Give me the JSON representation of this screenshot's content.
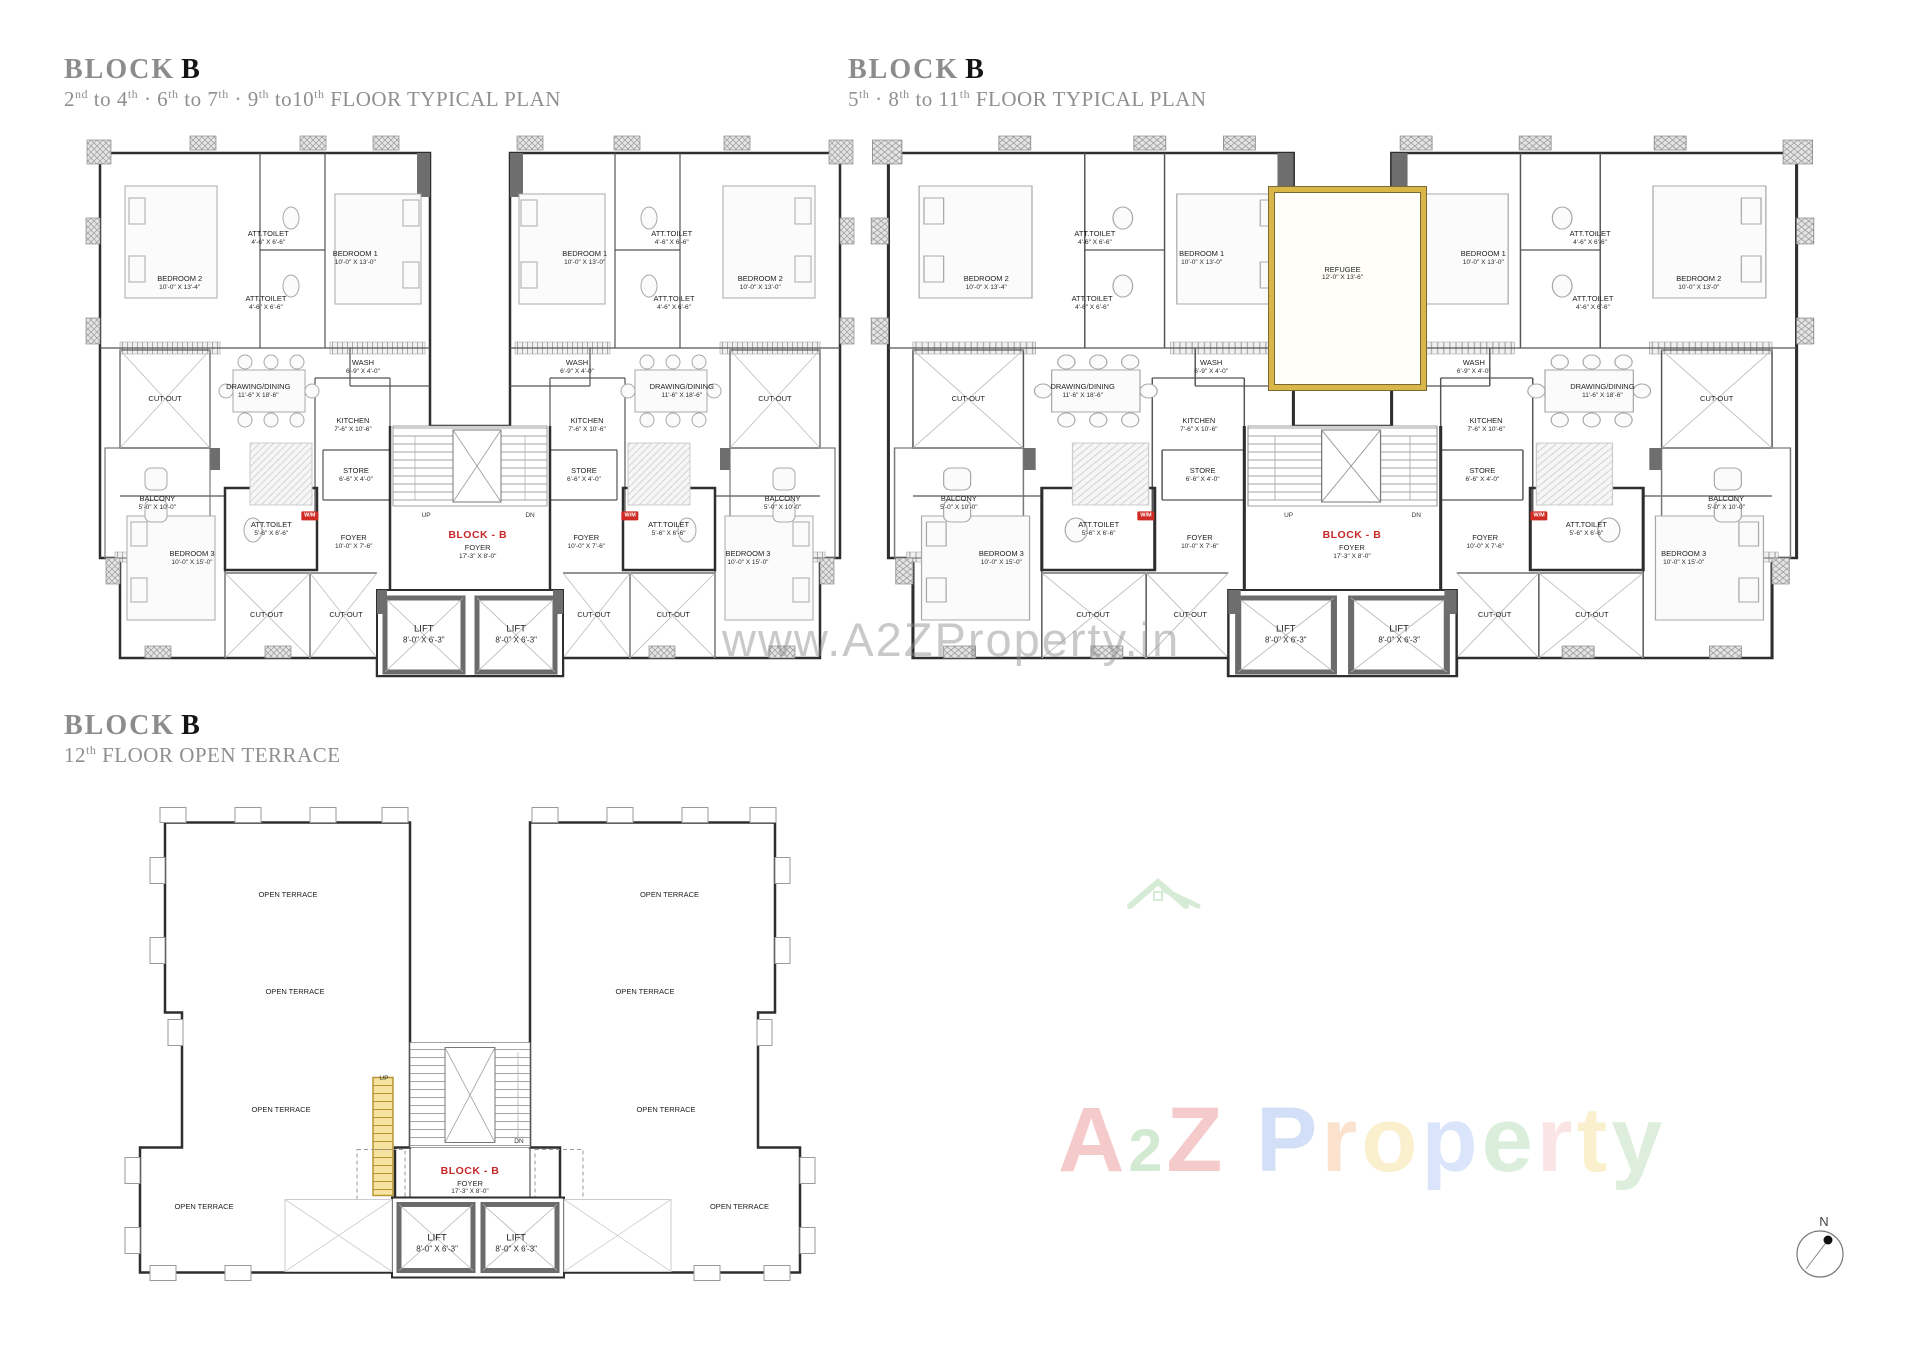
{
  "titles": [
    {
      "block": "BLOCK",
      "b": "B",
      "subtitle_parts": [
        [
          "2",
          "nd"
        ],
        [
          " to 4",
          "th"
        ],
        [
          " · 6",
          "th"
        ],
        [
          " to 7",
          "th"
        ],
        [
          " · 9",
          "th"
        ],
        [
          " to10",
          "th"
        ],
        [
          " FLOOR TYPICAL PLAN",
          ""
        ]
      ]
    },
    {
      "block": "BLOCK",
      "b": "B",
      "subtitle_parts": [
        [
          "5",
          "th"
        ],
        [
          " · 8",
          "th"
        ],
        [
          " to 11",
          "th"
        ],
        [
          " FLOOR TYPICAL PLAN",
          ""
        ]
      ]
    },
    {
      "block": "BLOCK",
      "b": "B",
      "subtitle_parts": [
        [
          "12",
          "th"
        ],
        [
          " FLOOR OPEN TERRACE",
          ""
        ]
      ]
    }
  ],
  "typical_rooms": [
    {
      "id": "bedroom2-left",
      "x": 12.3,
      "y": 27.7,
      "lines": [
        "BEDROOM 2",
        "10'-0\" X 13'-4\""
      ]
    },
    {
      "id": "att-toilet-upper-left",
      "x": 23.8,
      "y": 19.6,
      "lines": [
        "ATT.TOILET",
        "4'-6\" X 6'-6\""
      ]
    },
    {
      "id": "att-toilet-lower-left",
      "x": 23.5,
      "y": 31.3,
      "lines": [
        "ATT.TOILET",
        "4'-6\" X 6'-6\""
      ]
    },
    {
      "id": "bedroom1-left",
      "x": 35.1,
      "y": 23.2,
      "lines": [
        "BEDROOM 1",
        "10'-0\" X 13'-0\""
      ]
    },
    {
      "id": "wash-left",
      "x": 36.1,
      "y": 42.7,
      "lines": [
        "WASH",
        "6'-9\" X 4'-0\""
      ]
    },
    {
      "id": "cutout-upper-left",
      "x": 10.4,
      "y": 48.4,
      "lines": [
        "CUT-OUT"
      ]
    },
    {
      "id": "drawing-dining-left",
      "x": 22.5,
      "y": 47.0,
      "lines": [
        "DRAWING/DINING",
        "11'-6\" X 18'-6\""
      ]
    },
    {
      "id": "kitchen-left",
      "x": 34.8,
      "y": 53.0,
      "lines": [
        "KITCHEN",
        "7'-6\" X 10'-6\""
      ]
    },
    {
      "id": "balcony-left",
      "x": 9.4,
      "y": 67.0,
      "lines": [
        "BALCONY",
        "5'-0\" X 10'-0\""
      ]
    },
    {
      "id": "store-left",
      "x": 35.2,
      "y": 62.0,
      "lines": [
        "STORE",
        "6'-6\" X 4'-0\""
      ]
    },
    {
      "id": "att-toilet-foyer-left",
      "x": 24.2,
      "y": 71.6,
      "lines": [
        "ATT.TOILET",
        "5'-6\" X 6'-6\""
      ]
    },
    {
      "id": "foyer-left",
      "x": 34.9,
      "y": 74.0,
      "lines": [
        "FOYER",
        "10'-0\" X 7'-6\""
      ]
    },
    {
      "id": "bedroom3-left",
      "x": 13.9,
      "y": 76.8,
      "lines": [
        "BEDROOM 3",
        "10'-0\" X 15'-0\""
      ]
    },
    {
      "id": "cutout-bottom-left-1",
      "x": 23.6,
      "y": 87.0,
      "lines": [
        "CUT-OUT"
      ]
    },
    {
      "id": "cutout-bottom-left-2",
      "x": 33.9,
      "y": 87.0,
      "lines": [
        "CUT-OUT"
      ]
    },
    {
      "id": "wm-tag-left",
      "x": 29.2,
      "y": 69.3,
      "lines": [
        "W/M"
      ],
      "cls": "tag"
    },
    {
      "id": "up-label",
      "x": 44.3,
      "y": 69.3,
      "lines": [
        "UP"
      ],
      "cls": "tiny"
    },
    {
      "id": "dn-label",
      "x": 57.8,
      "y": 69.3,
      "lines": [
        "DN"
      ],
      "cls": "tiny"
    },
    {
      "id": "block-b-foyer",
      "x": 51.0,
      "y": 74.5,
      "lines": [
        "BLOCK - B",
        "FOYER",
        "17'-3\" X 8'-0\""
      ],
      "cls": "accent"
    },
    {
      "id": "lift-1",
      "x": 44.0,
      "y": 90.5,
      "lines": [
        "LIFT",
        "8'-0\" X 6'-3\""
      ],
      "cls": "lift"
    },
    {
      "id": "lift-2",
      "x": 56.0,
      "y": 90.5,
      "lines": [
        "LIFT",
        "8'-0\" X 6'-3\""
      ],
      "cls": "lift"
    },
    {
      "id": "bedroom2-right",
      "x": 87.7,
      "y": 27.7,
      "lines": [
        "BEDROOM 2",
        "10'-0\" X 13'-0\""
      ]
    },
    {
      "id": "att-toilet-upper-right",
      "x": 76.2,
      "y": 19.6,
      "lines": [
        "ATT.TOILET",
        "4'-6\" X 6'-6\""
      ]
    },
    {
      "id": "att-toilet-lower-right",
      "x": 76.5,
      "y": 31.3,
      "lines": [
        "ATT.TOILET",
        "4'-6\" X 6'-6\""
      ]
    },
    {
      "id": "bedroom1-right",
      "x": 64.9,
      "y": 23.2,
      "lines": [
        "BEDROOM 1",
        "10'-0\" X 13'-0\""
      ]
    },
    {
      "id": "wash-right",
      "x": 63.9,
      "y": 42.7,
      "lines": [
        "WASH",
        "6'-9\" X 4'-0\""
      ]
    },
    {
      "id": "cutout-upper-right",
      "x": 89.6,
      "y": 48.4,
      "lines": [
        "CUT-OUT"
      ]
    },
    {
      "id": "drawing-dining-right",
      "x": 77.5,
      "y": 47.0,
      "lines": [
        "DRAWING/DINING",
        "11'-6\" X 18'-6\""
      ]
    },
    {
      "id": "kitchen-right",
      "x": 65.2,
      "y": 53.0,
      "lines": [
        "KITCHEN",
        "7'-6\" X 10'-6\""
      ]
    },
    {
      "id": "balcony-right",
      "x": 90.6,
      "y": 67.0,
      "lines": [
        "BALCONY",
        "5'-0\" X 10'-0\""
      ]
    },
    {
      "id": "store-right",
      "x": 64.8,
      "y": 62.0,
      "lines": [
        "STORE",
        "6'-6\" X 4'-0\""
      ]
    },
    {
      "id": "att-toilet-foyer-right",
      "x": 75.8,
      "y": 71.6,
      "lines": [
        "ATT.TOILET",
        "5'-6\" X 6'-6\""
      ]
    },
    {
      "id": "foyer-right",
      "x": 65.1,
      "y": 74.0,
      "lines": [
        "FOYER",
        "10'-0\" X 7'-6\""
      ]
    },
    {
      "id": "bedroom3-right",
      "x": 86.1,
      "y": 76.8,
      "lines": [
        "BEDROOM 3",
        "10'-0\" X 15'-0\""
      ]
    },
    {
      "id": "cutout-bottom-right-1",
      "x": 76.4,
      "y": 87.0,
      "lines": [
        "CUT-OUT"
      ]
    },
    {
      "id": "cutout-bottom-right-2",
      "x": 66.1,
      "y": 87.0,
      "lines": [
        "CUT-OUT"
      ]
    },
    {
      "id": "wm-tag-right",
      "x": 70.8,
      "y": 69.3,
      "lines": [
        "W/M"
      ],
      "cls": "tag"
    }
  ],
  "refugee_extra": [
    {
      "id": "refugee-room",
      "x": 50.0,
      "y": 26.0,
      "lines": [
        "REFUGEE",
        "12'-0\" X 13'-6\""
      ]
    }
  ],
  "terrace_rooms": [
    {
      "id": "open-terrace-top-left",
      "x": 24.0,
      "y": 19.0,
      "lines": [
        "OPEN TERRACE"
      ]
    },
    {
      "id": "open-terrace-mid-left",
      "x": 25.0,
      "y": 37.5,
      "lines": [
        "OPEN TERRACE"
      ]
    },
    {
      "id": "open-terrace-lower-left",
      "x": 23.0,
      "y": 60.0,
      "lines": [
        "OPEN TERRACE"
      ]
    },
    {
      "id": "open-terrace-bottom-left",
      "x": 12.0,
      "y": 78.5,
      "lines": [
        "OPEN TERRACE"
      ]
    },
    {
      "id": "open-terrace-top-right",
      "x": 78.5,
      "y": 19.0,
      "lines": [
        "OPEN TERRACE"
      ]
    },
    {
      "id": "open-terrace-mid-right",
      "x": 75.0,
      "y": 37.5,
      "lines": [
        "OPEN TERRACE"
      ]
    },
    {
      "id": "open-terrace-lower-right",
      "x": 78.0,
      "y": 60.0,
      "lines": [
        "OPEN TERRACE"
      ]
    },
    {
      "id": "open-terrace-bottom-right",
      "x": 88.5,
      "y": 78.5,
      "lines": [
        "OPEN TERRACE"
      ]
    },
    {
      "id": "up-label",
      "x": 37.7,
      "y": 54.0,
      "lines": [
        "UP"
      ],
      "cls": "tiny"
    },
    {
      "id": "dn-label",
      "x": 57.0,
      "y": 66.0,
      "lines": [
        "DN"
      ],
      "cls": "tiny"
    },
    {
      "id": "block-b-foyer",
      "x": 50.0,
      "y": 73.5,
      "lines": [
        "BLOCK - B",
        "FOYER",
        "17'-3\" X 8'-0\""
      ],
      "cls": "accent"
    },
    {
      "id": "lift-1",
      "x": 45.3,
      "y": 85.5,
      "lines": [
        "LIFT",
        "8'-0\" X 6'-3\""
      ],
      "cls": "lift"
    },
    {
      "id": "lift-2",
      "x": 56.6,
      "y": 85.5,
      "lines": [
        "LIFT",
        "8'-0\" X 6'-3\""
      ],
      "cls": "lift"
    }
  ],
  "watermark": {
    "text": "www.A2ZProperty.in"
  },
  "logo": {
    "letters": [
      {
        "ch": "A",
        "c": "#e05252",
        "s": 1
      },
      {
        "ch": "2",
        "c": "#6cb96c",
        "s": 0.66
      },
      {
        "ch": "Z",
        "c": "#e05252",
        "s": 1
      },
      {
        "ch": " ",
        "c": "#000000",
        "s": 1
      },
      {
        "ch": "P",
        "c": "#6f96e8",
        "s": 1
      },
      {
        "ch": "r",
        "c": "#f0a058",
        "s": 1
      },
      {
        "ch": "o",
        "c": "#f0d060",
        "s": 1
      },
      {
        "ch": "p",
        "c": "#86a8f0",
        "s": 1
      },
      {
        "ch": "e",
        "c": "#8cc88c",
        "s": 1
      },
      {
        "ch": "r",
        "c": "#f0a8a8",
        "s": 1
      },
      {
        "ch": "t",
        "c": "#f0d060",
        "s": 1
      },
      {
        "ch": "y",
        "c": "#90c890",
        "s": 1
      }
    ]
  },
  "compass": {
    "label": "N"
  },
  "colors": {
    "accent_red": "#c62828",
    "refugee_gold": "#d8b64a",
    "title_gray": "#8c8c8c",
    "wall_dark": "#2e2e2e"
  }
}
